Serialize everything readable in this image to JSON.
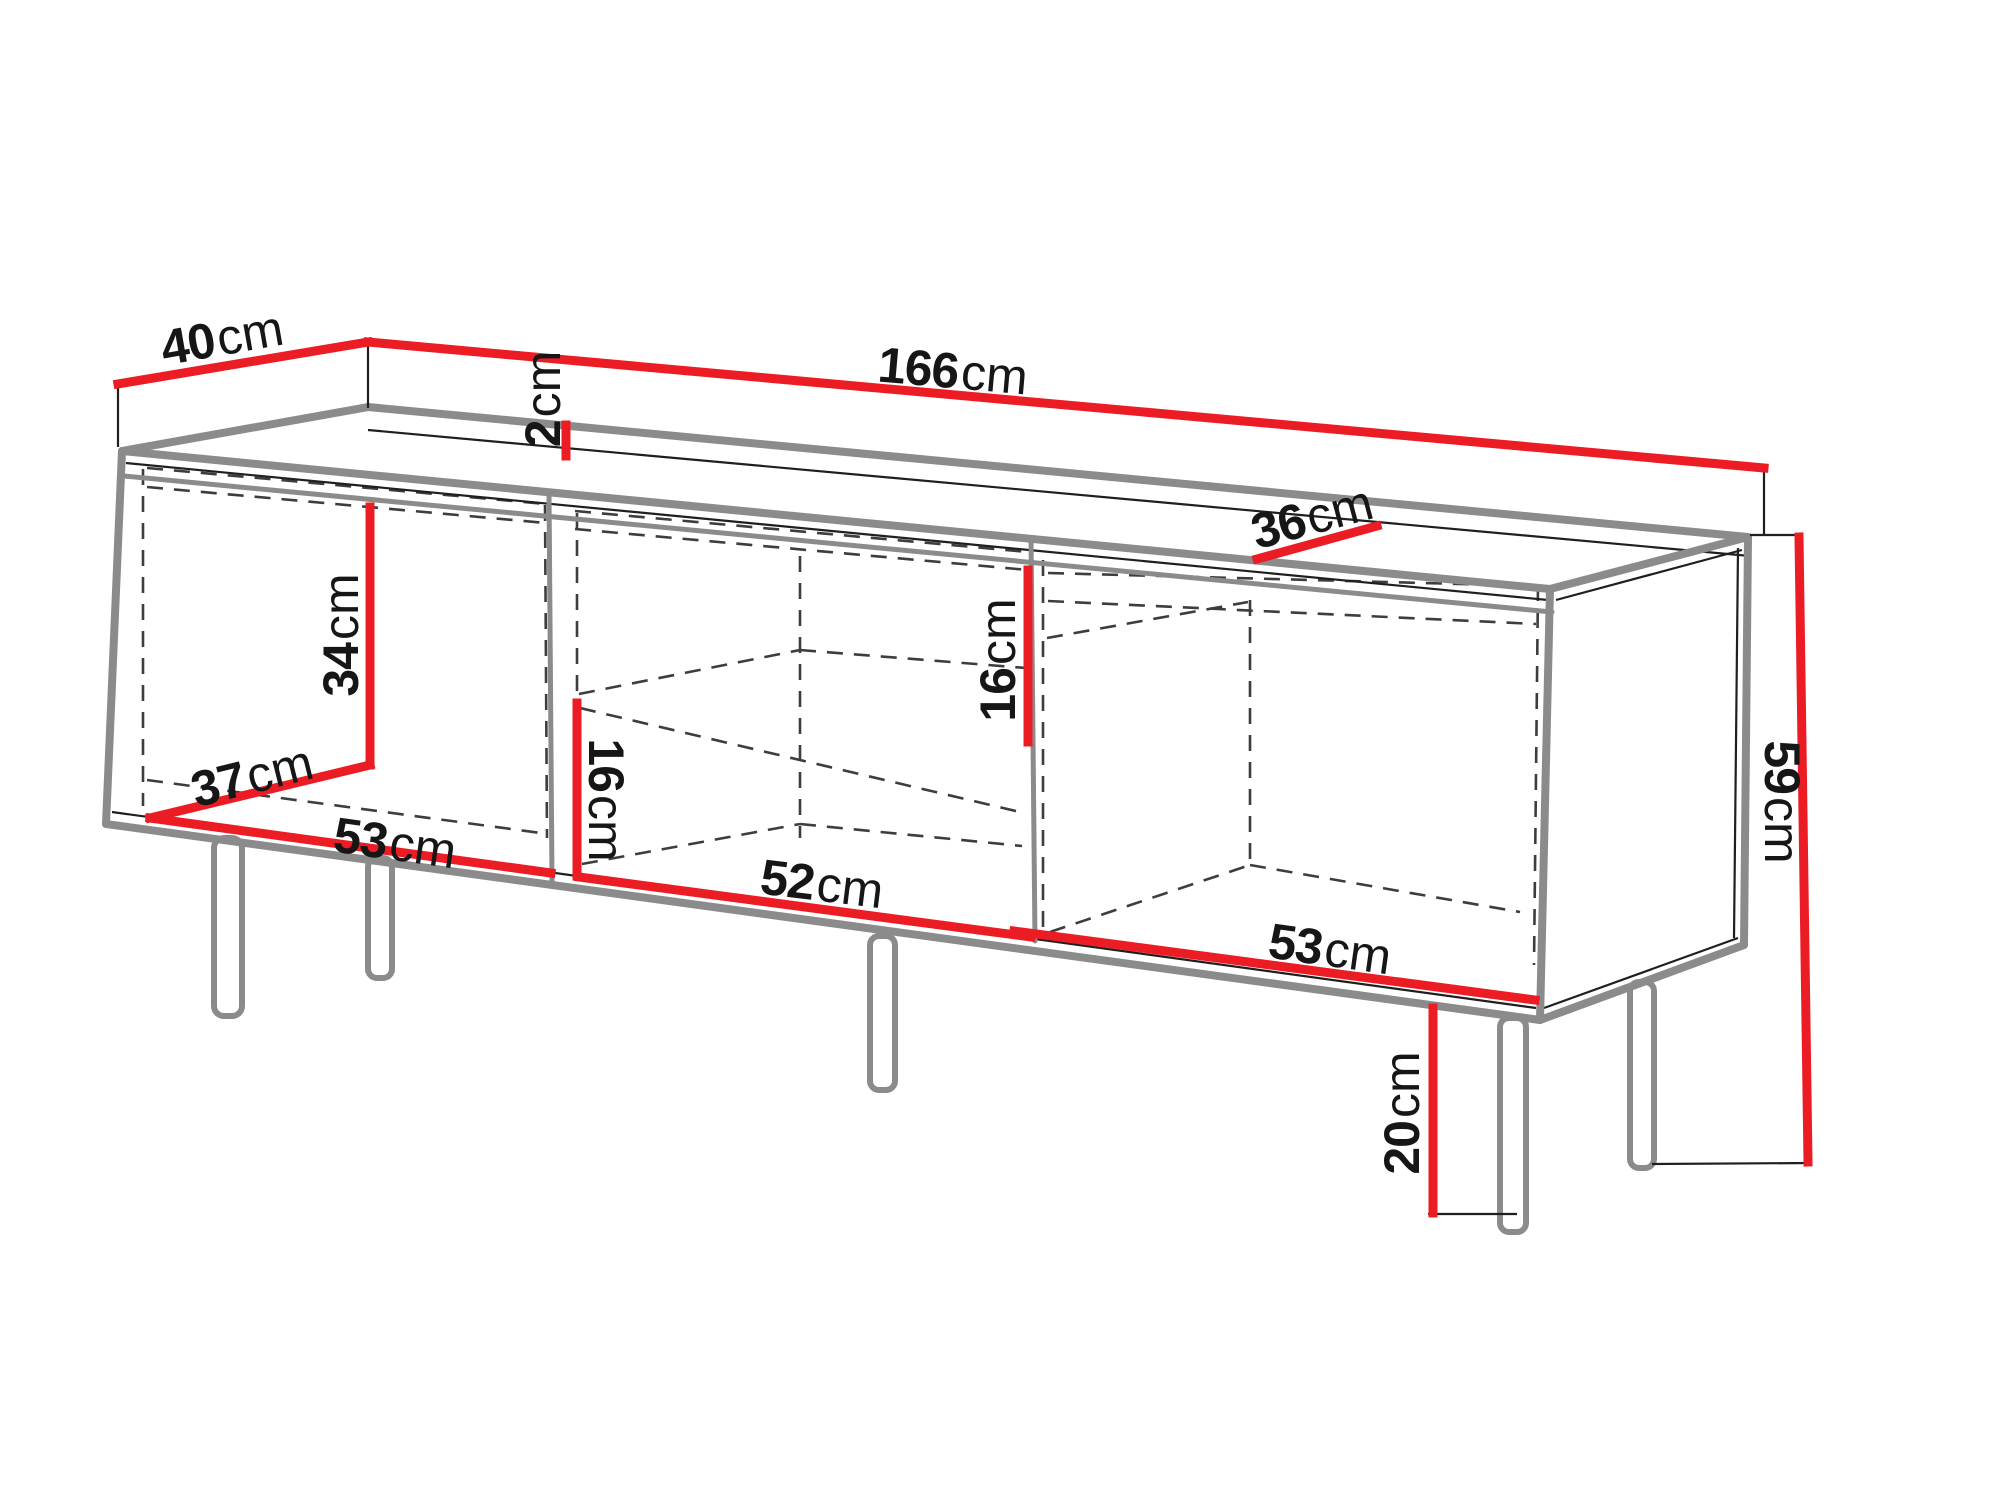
{
  "diagram": {
    "type": "furniture-dimension-drawing",
    "subject": "three-compartment TV cabinet on legs, perspective view with dimension callouts",
    "unit": "cm",
    "dimensions": [
      {
        "id": "top-depth",
        "value": "40",
        "unit": "cm"
      },
      {
        "id": "top-panel-thickness",
        "value": "2",
        "unit": "cm"
      },
      {
        "id": "total-width",
        "value": "166",
        "unit": "cm"
      },
      {
        "id": "interior-top-depth",
        "value": "36",
        "unit": "cm"
      },
      {
        "id": "left-interior-height",
        "value": "34",
        "unit": "cm"
      },
      {
        "id": "left-interior-depth",
        "value": "37",
        "unit": "cm"
      },
      {
        "id": "left-interior-width",
        "value": "53",
        "unit": "cm"
      },
      {
        "id": "middle-niche-height-left",
        "value": "16",
        "unit": "cm"
      },
      {
        "id": "middle-interior-width",
        "value": "52",
        "unit": "cm"
      },
      {
        "id": "middle-niche-height-right",
        "value": "16",
        "unit": "cm"
      },
      {
        "id": "right-interior-width",
        "value": "53",
        "unit": "cm"
      },
      {
        "id": "carcass-height",
        "value": "59",
        "unit": "cm"
      },
      {
        "id": "leg-height",
        "value": "20",
        "unit": "cm"
      }
    ],
    "colors": {
      "dimension_line": "#ec1c24",
      "outline": "#8b8b8b",
      "hidden_edge": "#3d3d3d",
      "text": "#161616",
      "background": "#ffffff"
    }
  }
}
